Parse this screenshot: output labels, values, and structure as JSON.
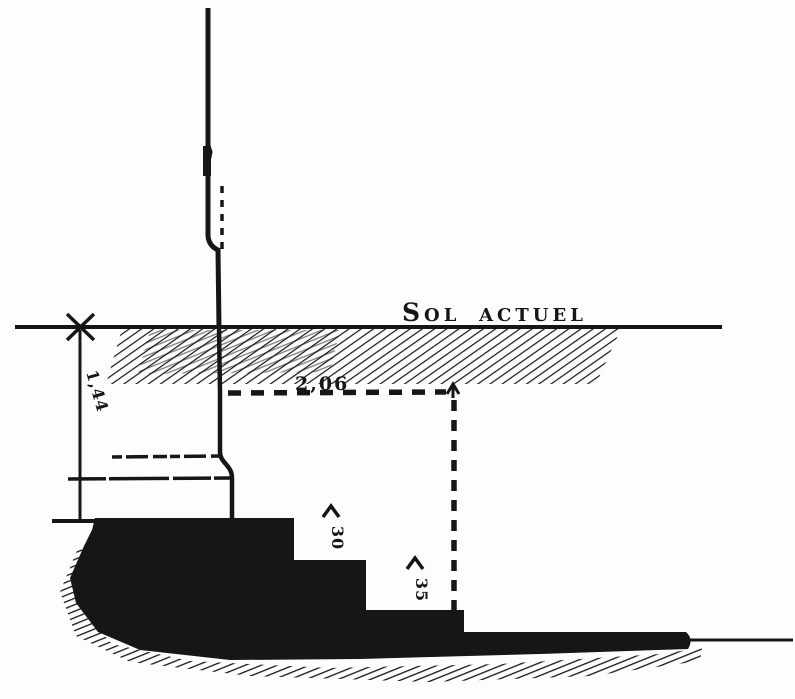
{
  "figure": {
    "type": "archaeological-section-drawing",
    "labels": {
      "ground": "Sol actuel",
      "depth": "1,44",
      "offset": "2,06",
      "step_riser_upper": "30",
      "step_riser_lower": "35"
    },
    "colors": {
      "ink": "#161616",
      "paper": "#fdfdfc"
    }
  }
}
